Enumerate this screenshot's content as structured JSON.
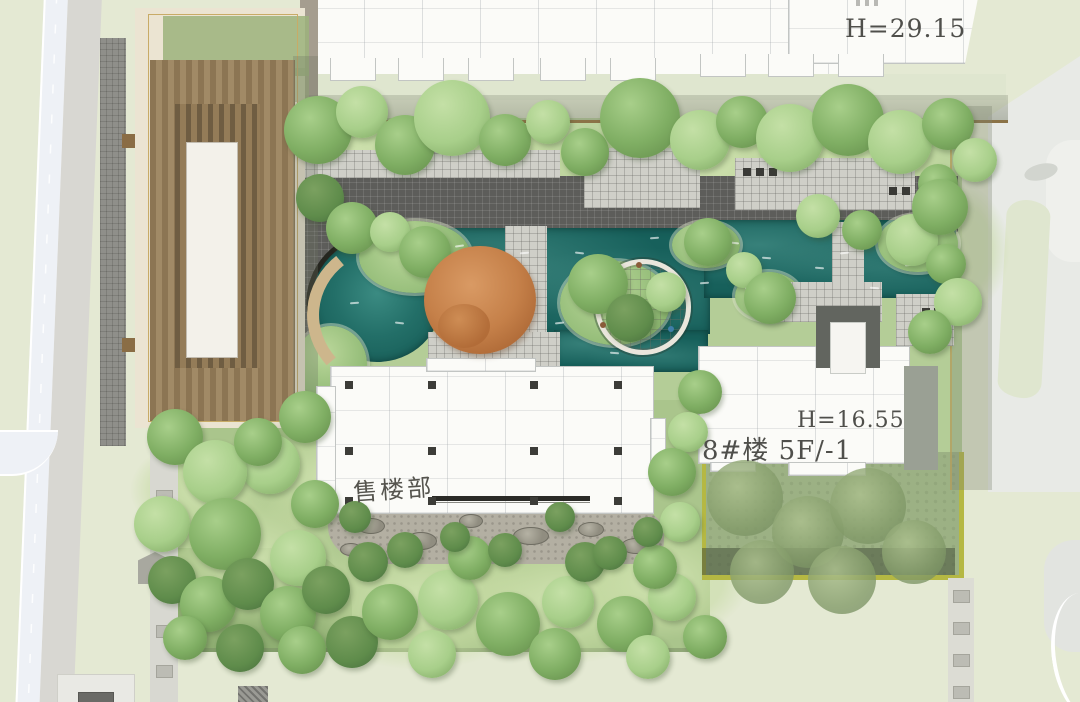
{
  "labels": {
    "north_building_height": "H=29.15",
    "building8_height": "H=16.55",
    "building8_name": "8#楼 5F/-1",
    "sales_office": "售楼部"
  },
  "colors": {
    "offsite_green": "#e4e9d3",
    "road": "#eef1f6",
    "road_line": "#ffffff",
    "sidewalk": "#d8d7d2",
    "wall_light": "#d8d8d1",
    "shadow_band": "#7d8470",
    "boundary_brown": "#8b7347",
    "cad_white": "#fbfbf8",
    "cad_line": "#c2c5c3",
    "label_gray": "#4f4f4b",
    "pergola_cream": "#ebe4d2",
    "pergola_brown": "#8d7758",
    "pergola_brown_dark": "#6f5d42",
    "pergola_white": "#f3f1ea",
    "roof_green": "#9cb37c",
    "gold_line": "#c8ab67",
    "lawn_light": "#c3d9a3",
    "lawn_mid": "#aac58c",
    "lawn_muted": "#9cb184",
    "lawn_pale": "#dfe6cf",
    "water_deep": "#17605b",
    "water_mid": "#2e7f78",
    "water_light": "#5aa79e",
    "paving_dark": "#5d5d5a",
    "paving_light": "#cfcfc8",
    "tan_path": "#cdb68c",
    "rockery": "#b3afa2",
    "stone": "#908d80",
    "olive": "#b5b843",
    "tree_dark": "#5f8c4b",
    "tree_mid": "#7fae63",
    "tree_light": "#a8cf8a",
    "tree_pale": "#c4e0a6",
    "orange_tree": "#c58049",
    "furniture_dark": "#3a3a36"
  }
}
